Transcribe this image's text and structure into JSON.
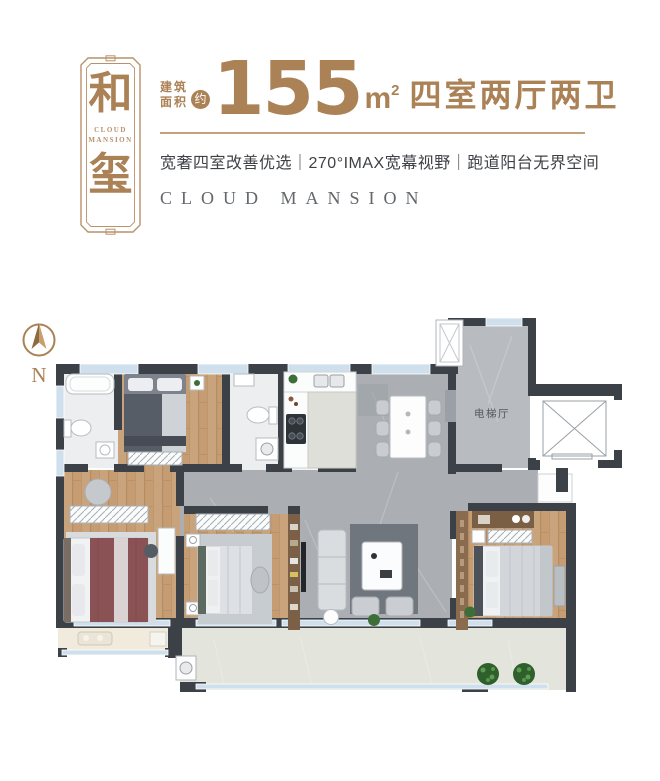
{
  "badge": {
    "char_top": "和",
    "char_bottom": "玺",
    "subtitle_line1": "CLOUD",
    "subtitle_line2": "MANSION"
  },
  "header": {
    "area_label_top": "建筑",
    "area_label_bottom": "面积",
    "approx_badge": "约",
    "area_value": "155",
    "area_unit": "m",
    "area_unit_sup": "2",
    "room_spec": "四室两厅两卫",
    "tagline": "宽奢四室改善优选｜270°IMAX宽幕视野｜跑道阳台无界空间",
    "brand_en": "CLOUD MANSION"
  },
  "floor_plan": {
    "compass_label": "N",
    "rooms": {
      "elevator_hall": "电梯厅"
    }
  },
  "colors": {
    "brand_brown": "#ab8156",
    "brand_brown_light": "#b9916b",
    "divider_tan": "#c2a17c",
    "tagline_dark": "#3e4145",
    "subtitle_gray": "#63676b",
    "wall": "#3c4147",
    "wood": "#c69d73",
    "wood_dark": "#b0875e",
    "marble": "#abafb4",
    "marble_light": "#b8bcc0",
    "bath_floor": "#eceef0",
    "window_blue": "#cfe0ec",
    "balcony_floor": "#e3e4db",
    "balcony_left_floor": "#f0ebdc",
    "plant_green": "#3c6e38"
  }
}
